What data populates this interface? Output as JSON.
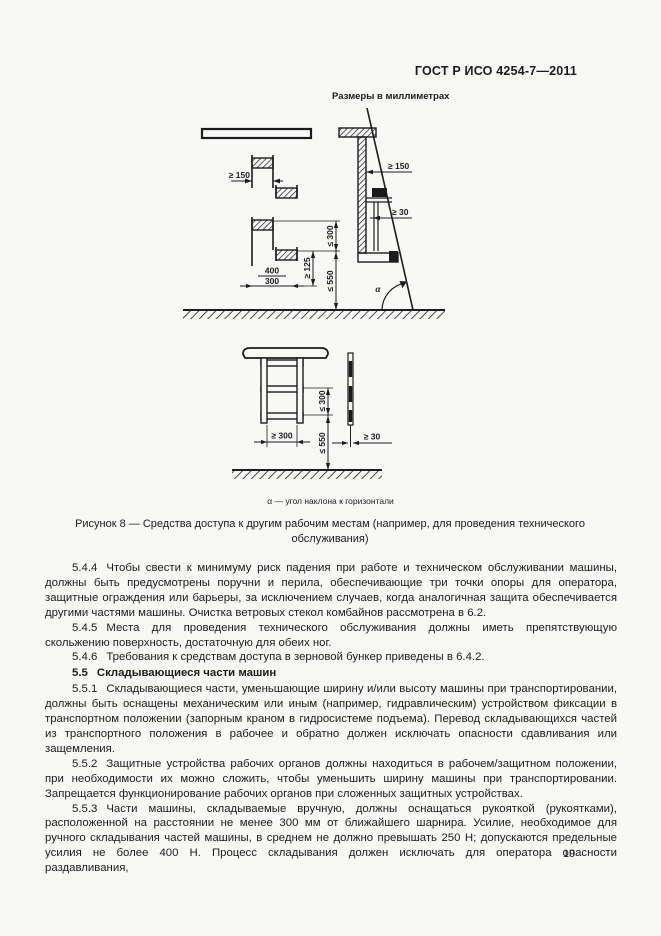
{
  "page": {
    "header_title": "ГОСТ Р ИСО 4254-7—2011",
    "page_number": "19"
  },
  "figure": {
    "units_label": "Размеры в миллиметрах",
    "alpha_note": "α — угол наклона к горизонтали",
    "caption": "Рисунок 8 — Средства доступа к другим рабочим местам (например, для проведения технического обслуживания)",
    "diagram1_dims": {
      "step_depth": "≥ 150",
      "width_preferred": "400",
      "width_min": "300",
      "step_pitch": "≤ 300",
      "clearance_height": "≥ 125",
      "first_step_height": "≤ 550",
      "toe_clearance": "≥ 150",
      "rung_clearance": "≥ 30",
      "angle_symbol": "α"
    },
    "diagram2_dims": {
      "rung_pitch": "≤ 300",
      "ladder_width": "≥ 300",
      "first_rung_height": "≤ 550",
      "rung_depth": "≥ 30"
    }
  },
  "content": {
    "paragraphs": [
      {
        "num": "5.4.4",
        "text": "Чтобы свести к минимуму риск падения при работе и техническом обслуживании машины, должны быть предусмотрены поручни и перила, обеспечивающие три точки опоры для оператора, защитные ограждения или барьеры, за исключением случаев, когда аналогичная защита обеспечивается другими частями машины. Очистка ветровых стекол комбайнов рассмотрена в 6.2."
      },
      {
        "num": "5.4.5",
        "text": "Места для проведения технического обслуживания должны иметь препятствующую скольжению поверхность, достаточную для обеих ног."
      },
      {
        "num": "5.4.6",
        "text": "Требования к средствам доступа в зерновой бункер приведены в 6.4.2."
      },
      {
        "num": "5.5",
        "text": "Складывающиеся части машин"
      },
      {
        "num": "5.5.1",
        "text": "Складывающиеся части, уменьшающие ширину и/или высоту машины при транспортировании, должны быть оснащены механическим или иным (например, гидравлическим) устройством фиксации в транспортном положении (запорным краном в гидросистеме подъема). Перевод складывающихся частей из транспортного положения в рабочее и обратно должен исключать опасности сдавливания или защемления."
      },
      {
        "num": "5.5.2",
        "text": "Защитные устройства рабочих органов должны находиться в рабочем/защитном положении, при необходимости их можно сложить, чтобы уменьшить ширину машины при транспортировании. Запрещается функционирование рабочих органов при сложенных защитных устройствах."
      },
      {
        "num": "5.5.3",
        "text": "Части машины, складываемые вручную, должны оснащаться рукояткой (рукоятками), расположенной на расстоянии не менее 300 мм от ближайшего шарнира. Усилие, необходимое для ручного складывания частей машины, в среднем не должно превышать 250 Н; допускаются предельные усилия не более 400 Н. Процесс складывания должен исключать для оператора опасности раздавливания,"
      }
    ]
  }
}
